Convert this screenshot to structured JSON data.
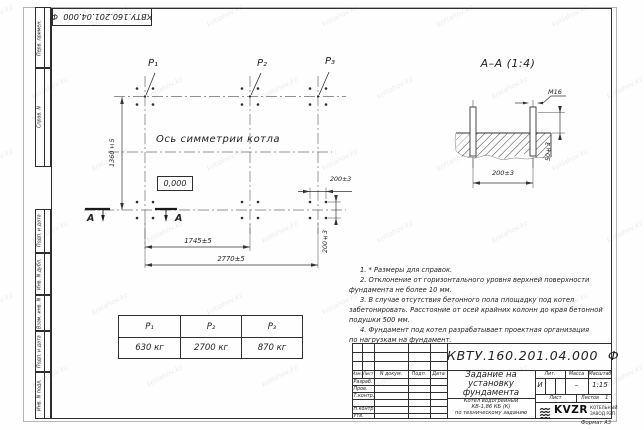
{
  "watermark": "kotlahov.kz",
  "frame": {
    "top_designation": "КВТУ.160.201.04.000  Ф",
    "format_label": "Формат А3",
    "margin_labels": [
      "Перв. примен.",
      "Справ. N",
      "Подп. и дата",
      "Инв. N дубл.",
      "Взам. инв. N",
      "Подп. и дата",
      "Инв. N подл."
    ]
  },
  "plan": {
    "point_labels": [
      "Р₁",
      "Р₂",
      "Р₃"
    ],
    "symmetry_axis_label": "Ось симметрии котла",
    "level_mark": "0,000",
    "dim_height": "1360±5",
    "dim_span_1": "1745±5",
    "dim_span_total": "2770±5",
    "dim_bolt_h": "200±3",
    "dim_bolt_v": "200±3",
    "section_letter_1": "А",
    "section_letter_2": "А"
  },
  "section": {
    "title": "А–А (1:4)",
    "thread_label": "М16",
    "dim_protrusion": "50±3",
    "dim_bolt_spacing": "200±3"
  },
  "notes": {
    "lines": [
      "1. * Размеры для справок.",
      "2. Отклонение от горизонтального уровня верхней поверхности",
      "фундамента не более 10 мм.",
      "3. В случае отсутствия бетонного пола площадку под котел",
      "забетонировать. Расстояние от осей крайних колонн до края бетонной",
      "подушки 500 мм.",
      "4. Фундамент под котел разрабатывает проектная организация",
      "по нагрузкам на фундамент."
    ]
  },
  "load_table": {
    "headers": [
      "Р₁",
      "Р₂",
      "Р₃"
    ],
    "values": [
      "630 кг",
      "2700 кг",
      "870 кг"
    ]
  },
  "title_block": {
    "designation": "КВТУ.160.201.04.000  Ф",
    "doc_title_lines": [
      "Задание на",
      "установку",
      "фундамента"
    ],
    "product_lines": [
      "Котел водогрейный",
      "КВ-1,86 КБ (К)",
      "по техническому заданию"
    ],
    "header_cols": [
      "Изм.",
      "Лист",
      "N докум.",
      "Подп.",
      "Дата"
    ],
    "row_labels": [
      "Разраб.",
      "Пров.",
      "Т.контр.",
      "Н.контр.",
      "Утв."
    ],
    "lit_label": "Лит.",
    "lit_value": "И",
    "mass_label": "Масса",
    "mass_value": "–",
    "scale_label": "Масштаб",
    "scale_value": "1:15",
    "sheet_label": "Лист",
    "sheets_label": "Листов",
    "sheets_value": "1",
    "logo_text": "KVZR",
    "logo_sub_lines": [
      "КОТЕЛЬНЫЙ",
      "ЗАВОД РЭП"
    ]
  }
}
